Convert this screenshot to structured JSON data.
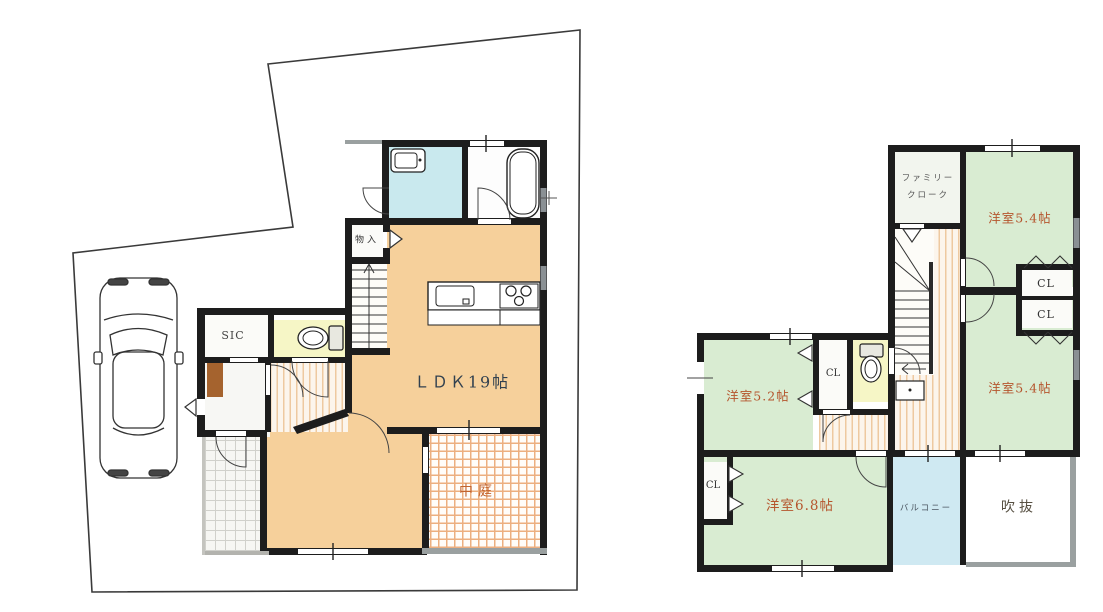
{
  "first_floor": {
    "ldk": "ＬＤＫ19帖",
    "courtyard": "中庭",
    "storage": "物入",
    "shoe_closet": "SIC"
  },
  "second_floor": {
    "family_cloak_line1": "ファミリー",
    "family_cloak_line2": "クローク",
    "bedroom_top": "洋室5.4帖",
    "bedroom_right": "洋室5.4帖",
    "bedroom_52": "洋室5.2帖",
    "bedroom_68": "洋室6.8帖",
    "closet_top1": "CL",
    "closet_top2": "CL",
    "closet_52": "CL",
    "closet_68": "CL",
    "balcony": "バルコニー",
    "void": "吹抜"
  },
  "colors": {
    "wall": "#1d1d1d",
    "ldk_fill": "#f6d09b",
    "bedroom_fill": "#d9ecd2",
    "washroom_fill": "#c9e9ee",
    "balcony_fill": "#cfe9f2",
    "toilet_fill": "#f6f6c6",
    "courtyard_grid": "#ecaf7f",
    "room_label": "#b5552d",
    "ldk_label": "#31404f",
    "void_label": "#564f41",
    "eave_gray": "#9aa0a0"
  }
}
